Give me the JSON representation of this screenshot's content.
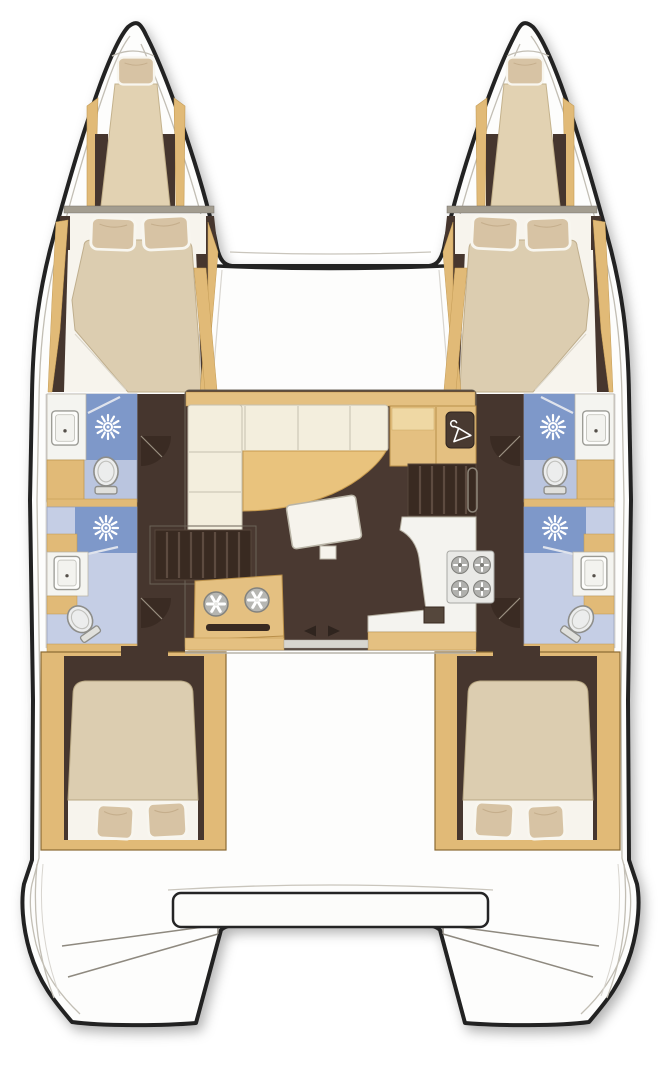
{
  "diagram": {
    "type": "boat-deck-plan",
    "subject": "sailing catamaran interior layout, top-down plan view",
    "orientation": {
      "bow": "top",
      "stern": "bottom"
    },
    "symmetry": "twin hulls mirrored port/starboard",
    "palette": {
      "hull_outline": "#232323",
      "deck_white": "#fdfdfc",
      "floor_dark_brown": "#46362e",
      "wood_tan": "#e1ba77",
      "wood_tan_light": "#efd8a4",
      "table_tan": "#e9c37d",
      "bed_cream": "#dccdb0",
      "pillow": "#d7c3a4",
      "sheet_white": "#f7f4ed",
      "sofa_cream": "#f3eedd",
      "bath_floor_blue": "#bac5df",
      "bath_floor_blue_light": "#c5cee5",
      "shower_blue": "#7e98c9",
      "fixture_white": "#eceded",
      "steps_dark": "#392a21",
      "bulkhead_gray": "#a39d90"
    },
    "port_hull": {
      "rooms": [
        {
          "name": "bow berth",
          "fixtures": [
            "single berth",
            "pillow"
          ]
        },
        {
          "name": "forward cabin",
          "fixtures": [
            "double berth",
            "pillow",
            "pillow"
          ]
        },
        {
          "name": "forward head",
          "fixtures": [
            "shower",
            "toilet",
            "washbasin",
            "vanity cabinet"
          ]
        },
        {
          "name": "aft head",
          "fixtures": [
            "shower",
            "toilet",
            "washbasin"
          ]
        },
        {
          "name": "aft cabin",
          "fixtures": [
            "double berth",
            "pillow",
            "pillow"
          ]
        },
        {
          "name": "transom",
          "fixtures": [
            "swim steps"
          ]
        }
      ]
    },
    "starboard_hull": {
      "rooms": [
        {
          "name": "bow berth",
          "fixtures": [
            "single berth",
            "pillow"
          ]
        },
        {
          "name": "forward cabin",
          "fixtures": [
            "double berth",
            "pillow",
            "pillow"
          ]
        },
        {
          "name": "forward head",
          "fixtures": [
            "shower",
            "toilet",
            "washbasin",
            "vanity cabinet"
          ]
        },
        {
          "name": "aft head",
          "fixtures": [
            "shower",
            "toilet",
            "washbasin"
          ]
        },
        {
          "name": "aft cabin",
          "fixtures": [
            "double berth",
            "pillow",
            "pillow"
          ]
        },
        {
          "name": "transom",
          "fixtures": [
            "swim steps"
          ]
        }
      ]
    },
    "bridgedeck_saloon": {
      "fixtures": [
        "L-shaped sofa",
        "curved dining table",
        "coffee table",
        "storage cabinet with hanging-locker (hanger icon)",
        "companionway steps to port hull",
        "companionway steps to starboard hull",
        "galley double round sink unit",
        "galley counter with 4-burner hob",
        "sliding aft door (left/right arrows)"
      ],
      "hob_burners": 4,
      "sink_dials": 2
    },
    "foredeck": {
      "forward_crossbeam": true
    },
    "stern": {
      "aft_bench_seat": true,
      "transom_step_lines_per_hull": 2
    },
    "totals": {
      "cabins": 4,
      "bow_berths": 2,
      "heads": 4,
      "showers": 4
    }
  }
}
